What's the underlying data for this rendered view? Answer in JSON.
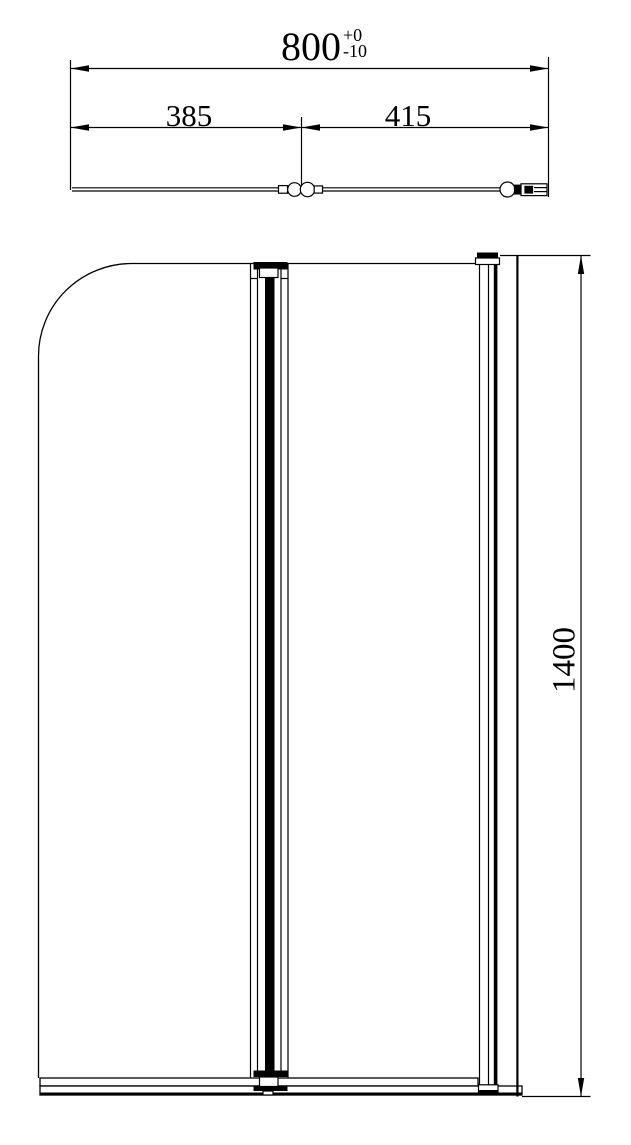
{
  "top_view": {
    "overall_width": {
      "value": "800",
      "tol_upper": "+0",
      "tol_lower": "-10"
    },
    "segment_left": {
      "value": "385"
    },
    "segment_right": {
      "value": "415"
    }
  },
  "front_view": {
    "height": {
      "value": "1400"
    }
  },
  "colors": {
    "line": "#000000",
    "background": "#ffffff"
  }
}
